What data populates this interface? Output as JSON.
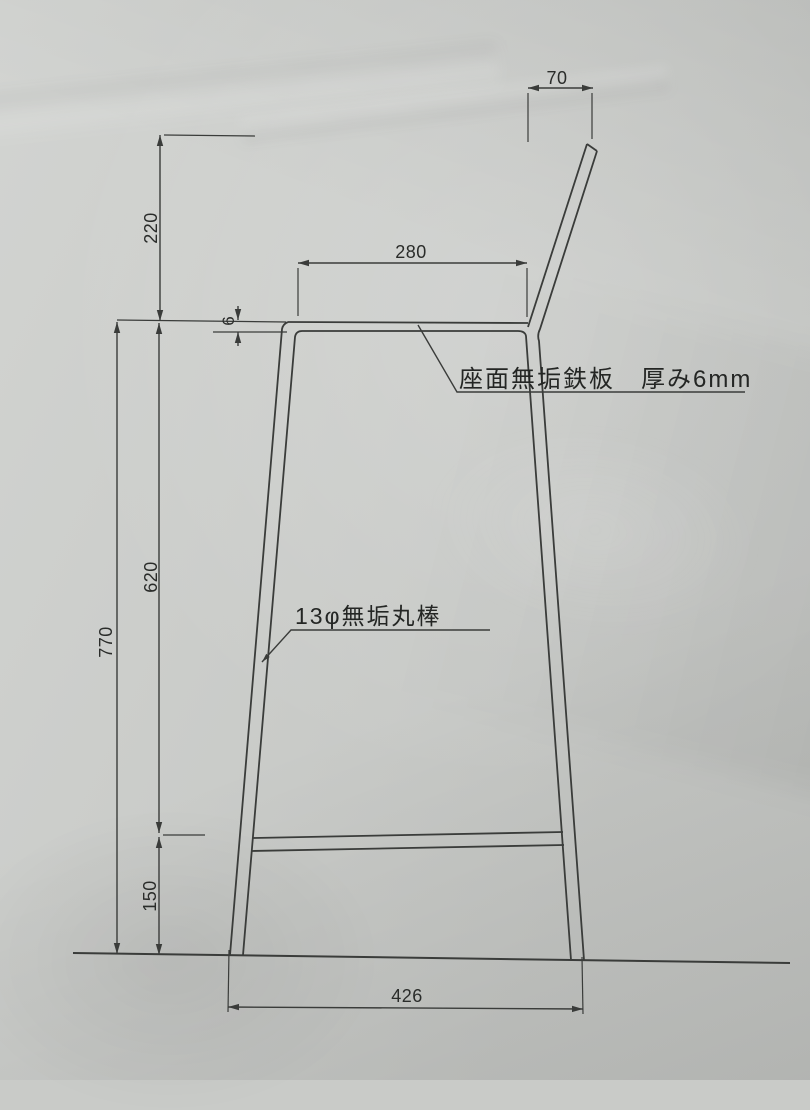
{
  "drawing": {
    "type": "technical-drawing",
    "subject": "bar stool side elevation on paper",
    "dimensions_mm": {
      "backrest_top_width": "70",
      "seat_depth": "280",
      "backrest_height": "220",
      "seat_plate_thickness": "6",
      "seat_to_footrest": "620",
      "seat_height": "770",
      "footrest_height": "150",
      "base_width": "426"
    },
    "notes": {
      "seat_material": "座面無垢鉄板　厚み6mm",
      "leg_material": "13φ無垢丸棒"
    },
    "colors": {
      "paper": "#cdcfcc",
      "ink": "#3a3c3a"
    }
  }
}
